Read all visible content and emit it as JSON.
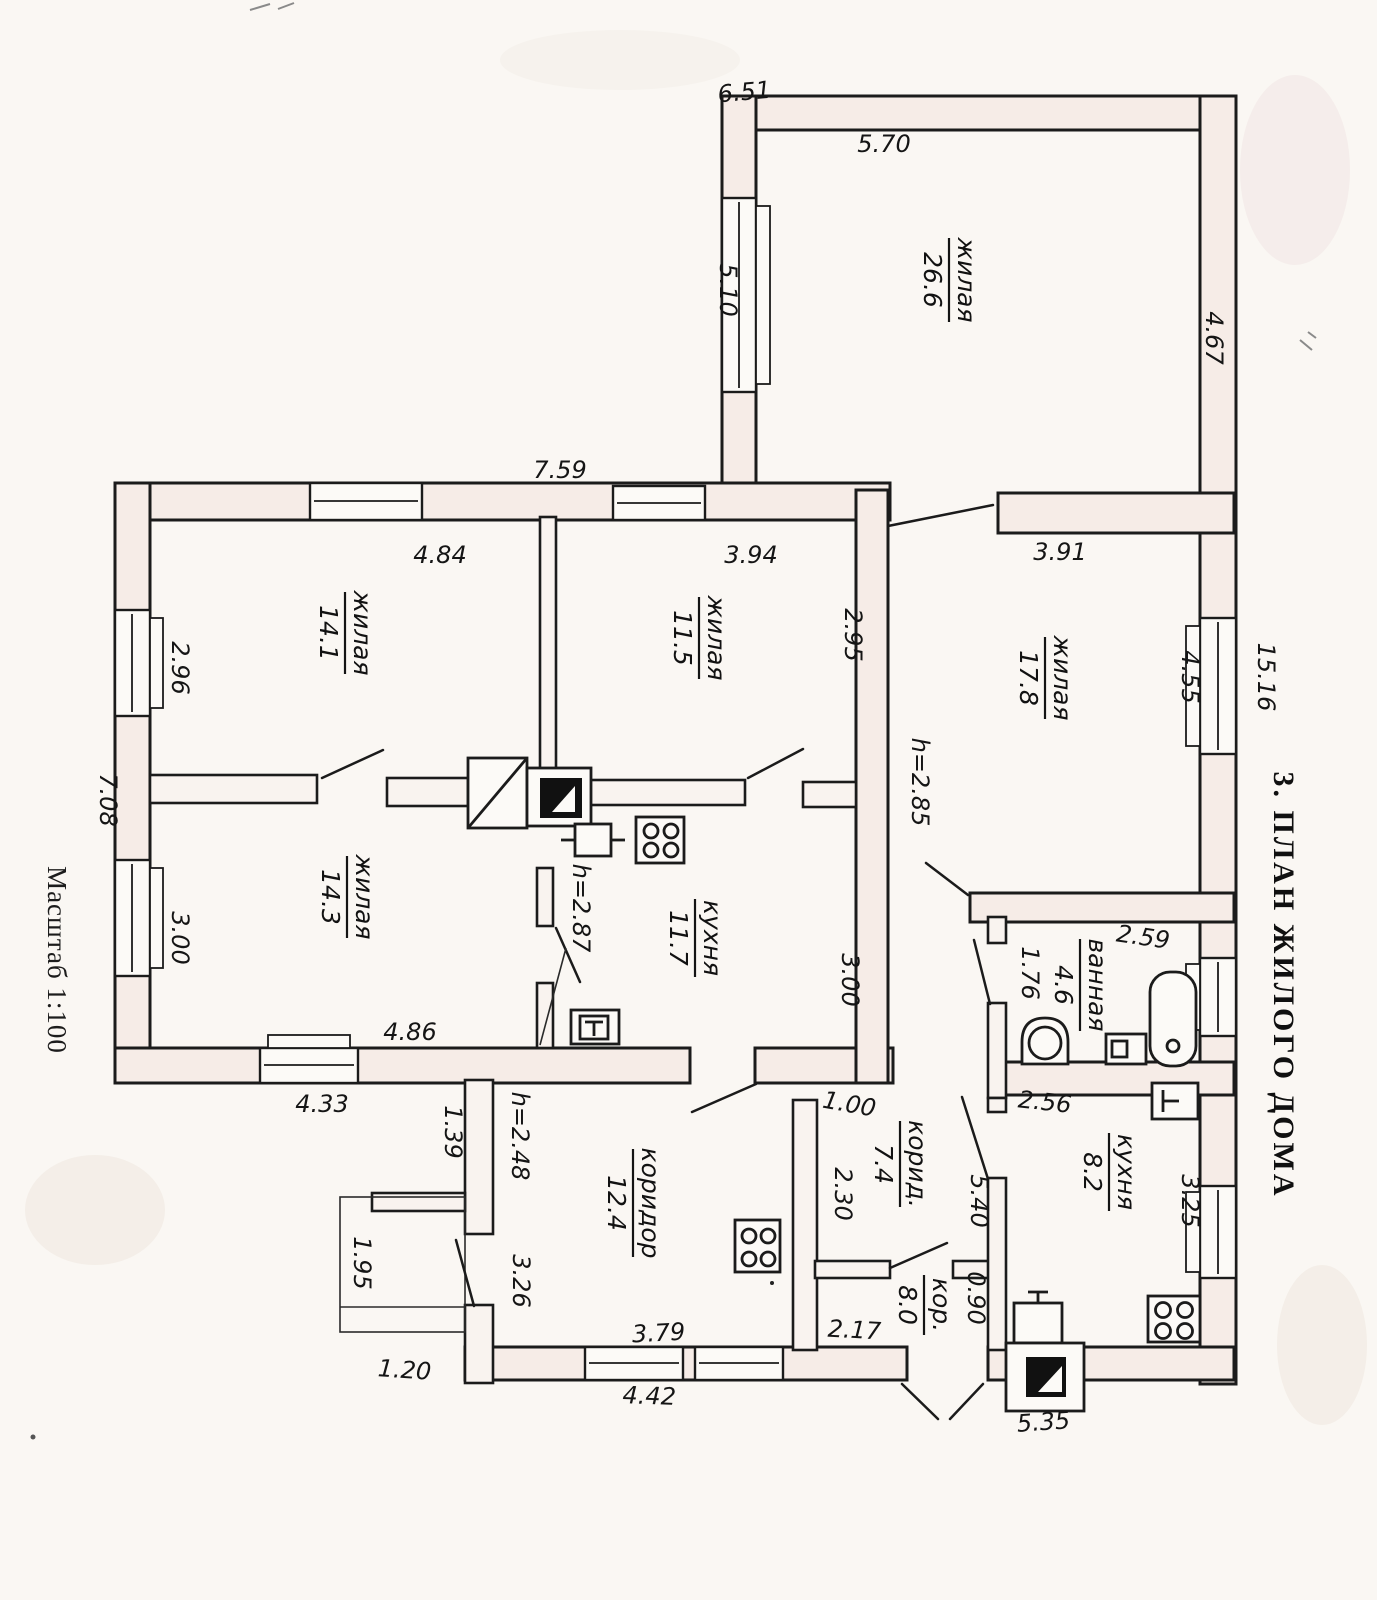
{
  "document": {
    "title": "3. ПЛАН ЖИЛОГО ДОМА",
    "scale_note": "Масштаб 1:100"
  },
  "rooms": [
    {
      "name": "жилая",
      "area": "26.6"
    },
    {
      "name": "жилая",
      "area": "14.1"
    },
    {
      "name": "жилая",
      "area": "11.5"
    },
    {
      "name": "жилая",
      "area": "17.8"
    },
    {
      "name": "жилая",
      "area": "14.3"
    },
    {
      "name": "кухня",
      "area": "11.7"
    },
    {
      "name": "ванная",
      "area": "4.6"
    },
    {
      "name": "кухня",
      "area": "8.2"
    },
    {
      "name": "коридор",
      "area": "12.4"
    },
    {
      "name": "корид.",
      "area": "7.4"
    },
    {
      "name": "кор.",
      "area": "8.0"
    }
  ],
  "dims": [
    {
      "t": "6.51"
    },
    {
      "t": "5.70"
    },
    {
      "t": "4.67"
    },
    {
      "t": "5.10"
    },
    {
      "t": "7.59"
    },
    {
      "t": "4.84"
    },
    {
      "t": "3.94"
    },
    {
      "t": "3.91"
    },
    {
      "t": "2.95"
    },
    {
      "t": "4.55"
    },
    {
      "t": "15.16"
    },
    {
      "t": "2.96"
    },
    {
      "t": "7.08"
    },
    {
      "t": "3.00"
    },
    {
      "t": "h=2.85"
    },
    {
      "t": "h=2.87"
    },
    {
      "t": "3.00"
    },
    {
      "t": "4.86"
    },
    {
      "t": "4.33"
    },
    {
      "t": "1.39"
    },
    {
      "t": "h=2.48"
    },
    {
      "t": "2.59"
    },
    {
      "t": "1.76"
    },
    {
      "t": "2.56"
    },
    {
      "t": "1.00"
    },
    {
      "t": "2.30"
    },
    {
      "t": "5.40"
    },
    {
      "t": "3.25"
    },
    {
      "t": "0.90"
    },
    {
      "t": "1.95"
    },
    {
      "t": "3.26"
    },
    {
      "t": "1.20"
    },
    {
      "t": "3.79"
    },
    {
      "t": "4.42"
    },
    {
      "t": "2.17"
    },
    {
      "t": "5.35"
    }
  ],
  "colors": {
    "ink": "#1b1b1b",
    "paper": "#faf7f3",
    "wall_tint": "#f6ece7"
  }
}
